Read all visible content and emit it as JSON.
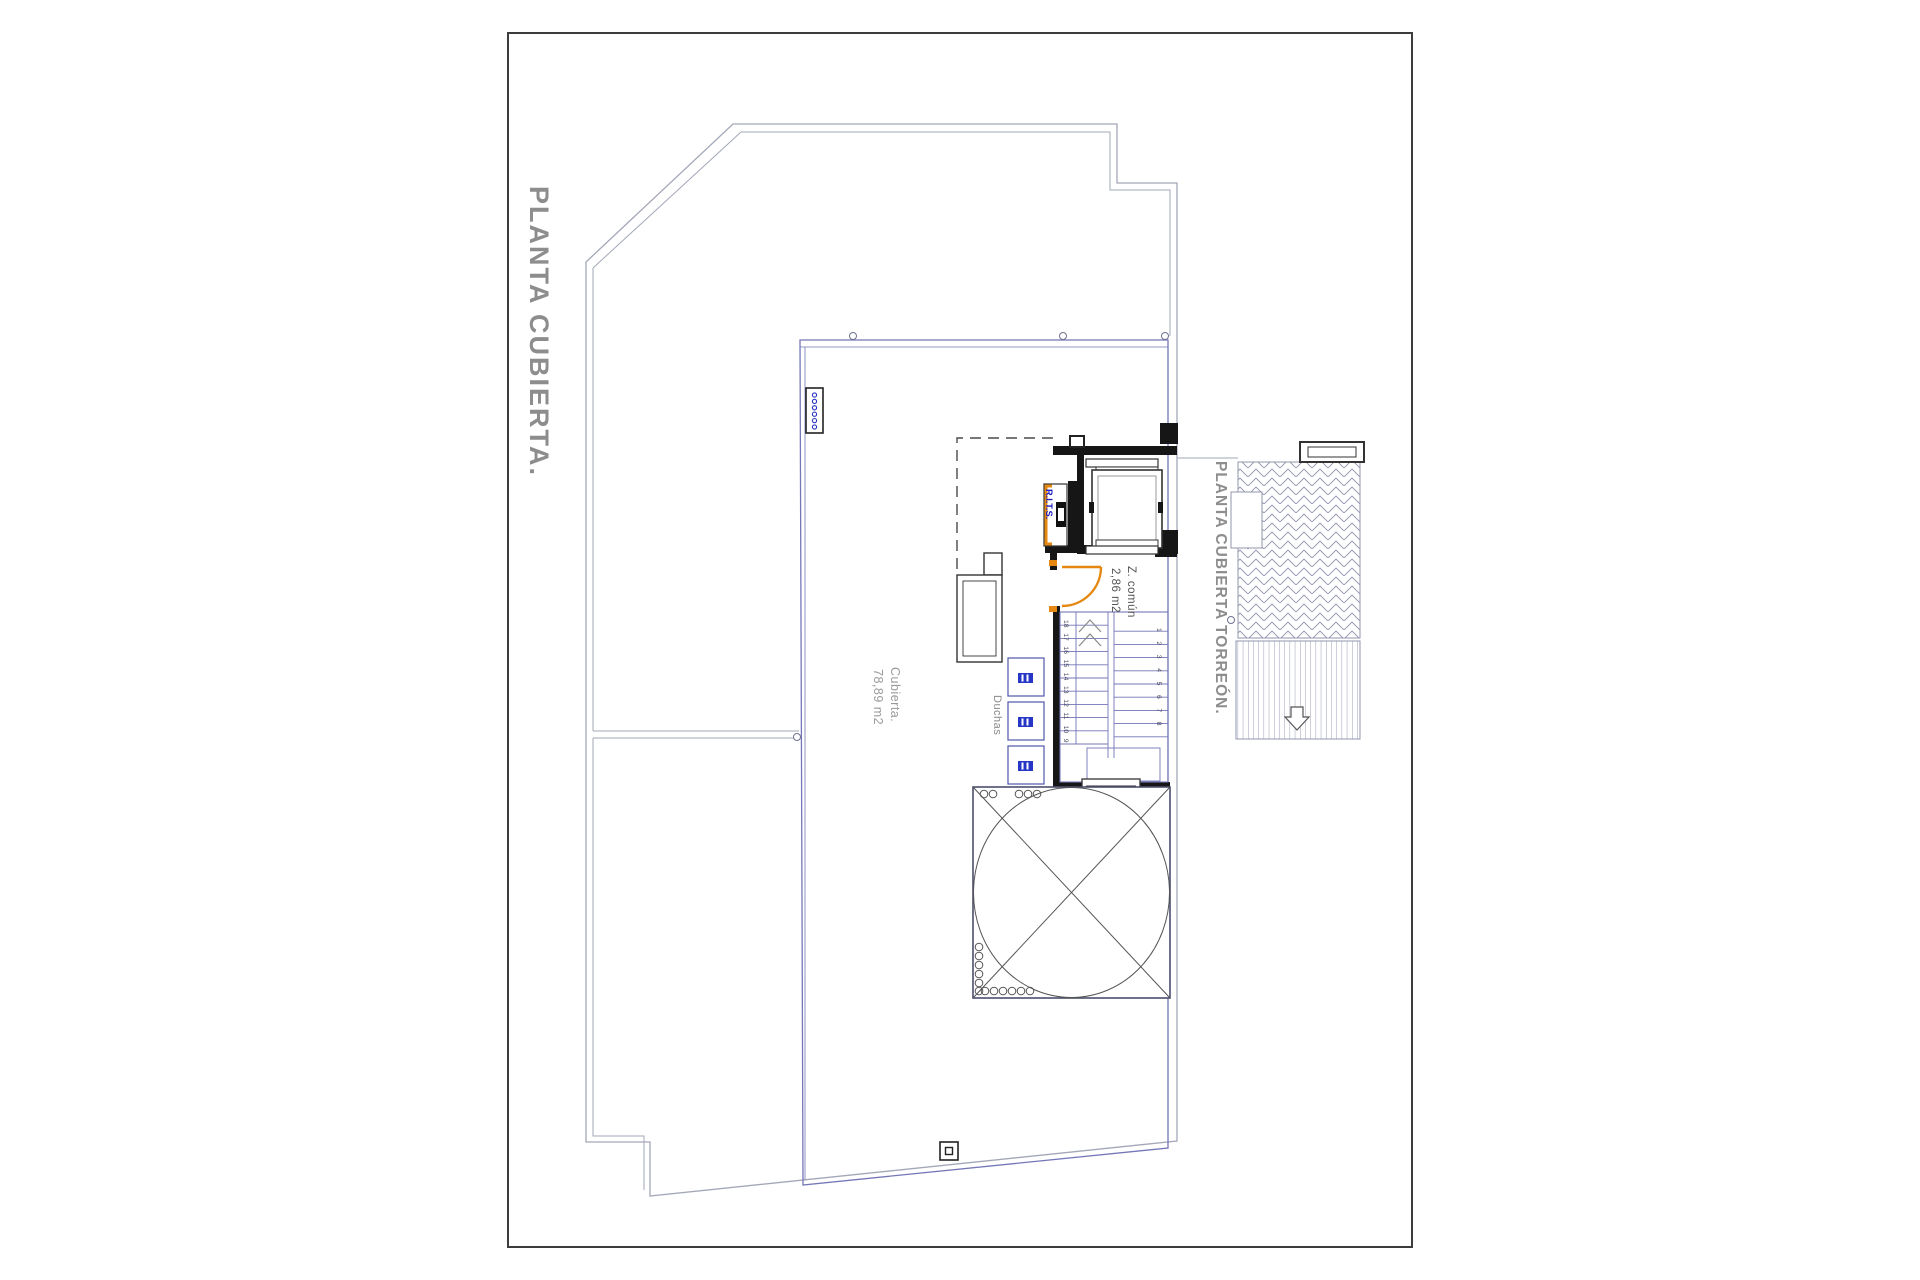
{
  "titles": {
    "main": "PLANTA CUBIERTA.",
    "torreon": "PLANTA CUBIERTA TORREÓN."
  },
  "labels": {
    "cubierta_name": "Cubierta.",
    "cubierta_area": "78,89 m2",
    "duchas": "Duchas",
    "zcomun_name": "Z. común",
    "zcomun_area": "2,86 m2",
    "rits": "R.I.T.S."
  },
  "stairs": {
    "left_numbers": [
      "18",
      "17",
      "16",
      "15",
      "14",
      "13",
      "12",
      "11",
      "10",
      "9"
    ],
    "right_numbers": [
      "1",
      "2",
      "3",
      "4",
      "5",
      "6",
      "7",
      "8"
    ]
  },
  "symbols": {
    "decking_arrow": "down-arrow",
    "door_swing": "quarter-arc",
    "skylight": "circle-with-cross"
  },
  "colors": {
    "accent_orange": "#E6870F",
    "plan_blue": "#7476B8",
    "rits_blue": "#1A1AC2",
    "wall_black": "#161616",
    "line_grey": "#A3A7B7",
    "text_grey": "#8D8D8D"
  }
}
